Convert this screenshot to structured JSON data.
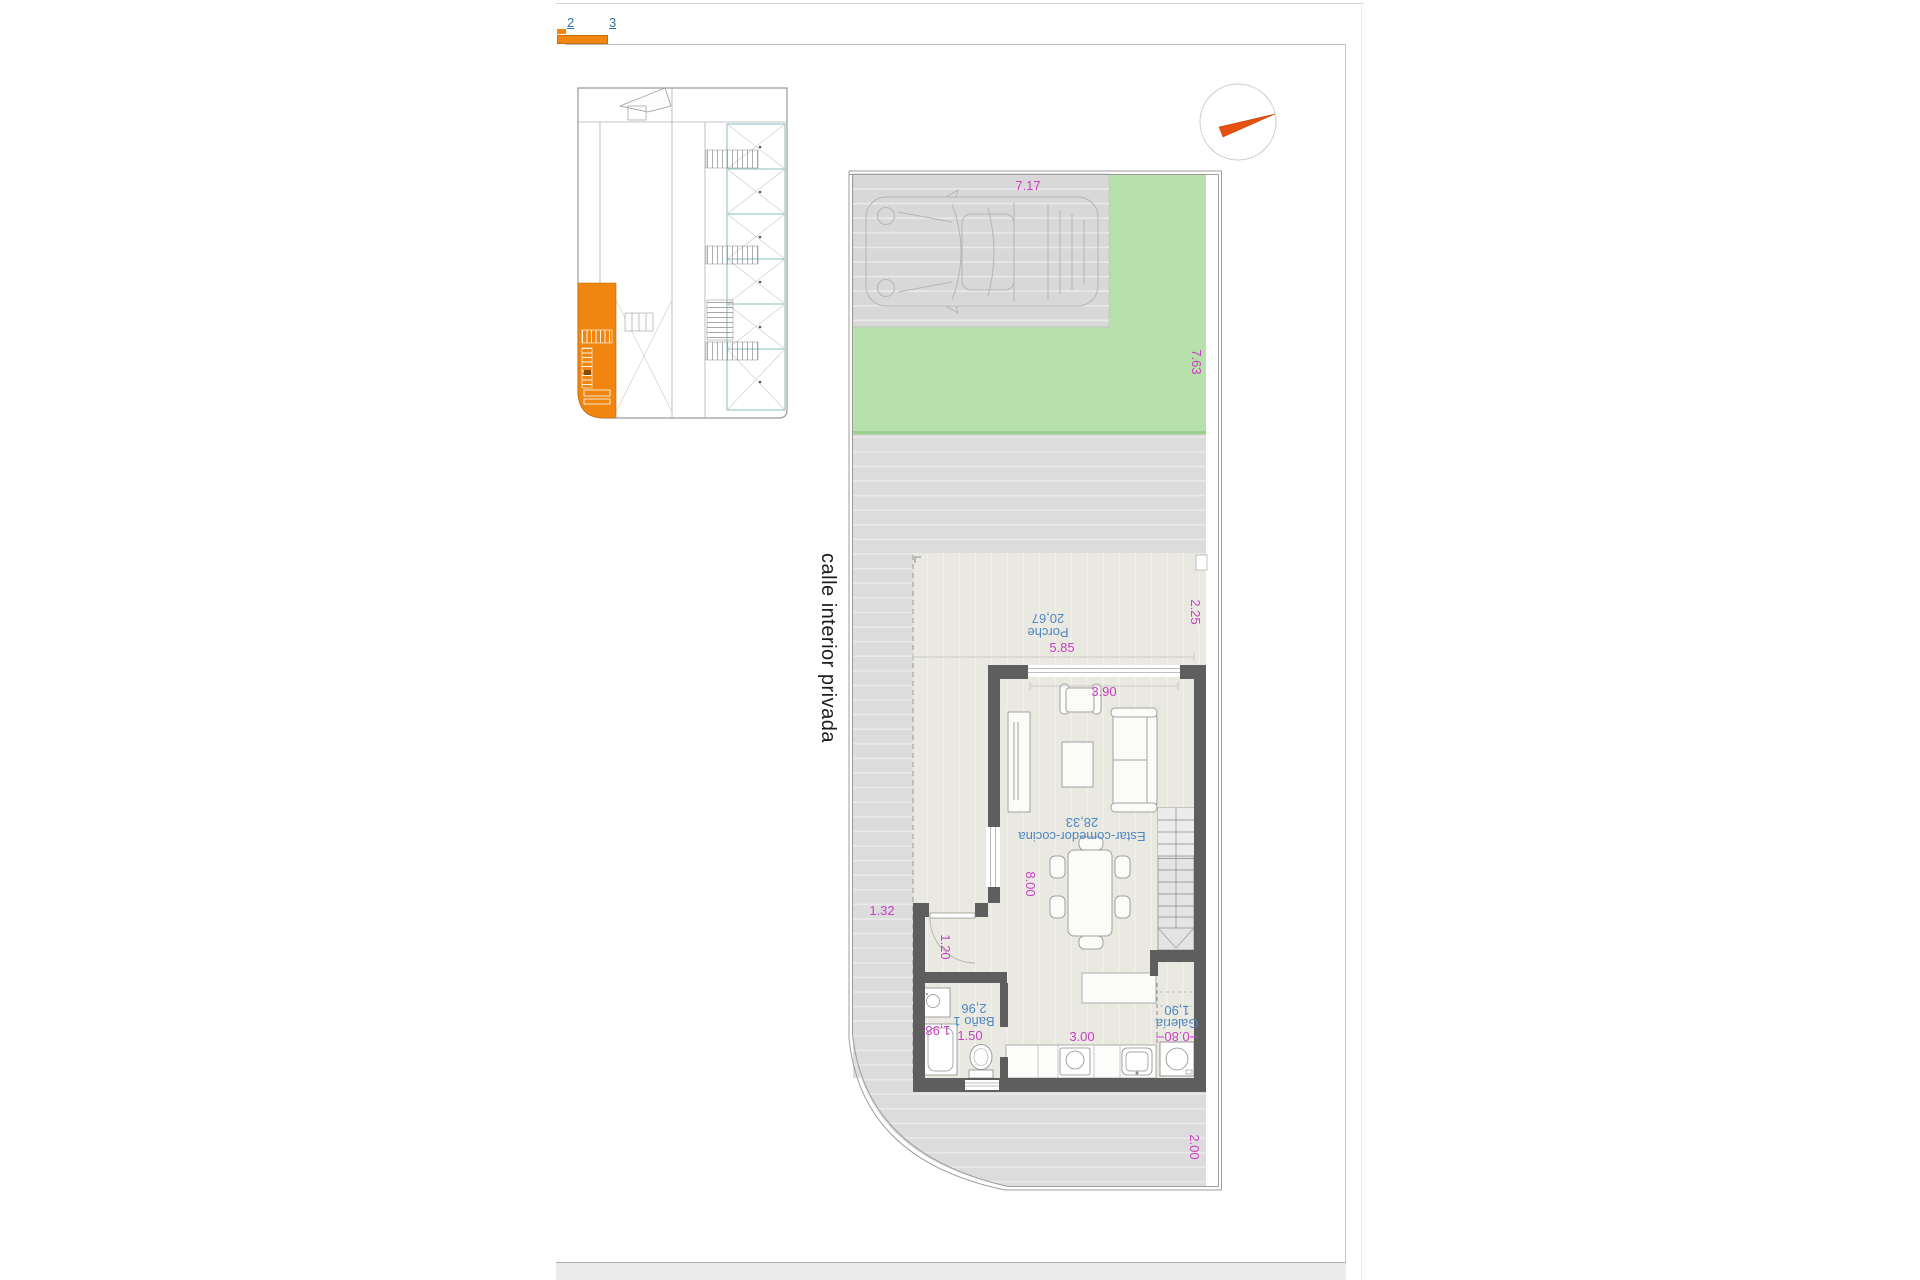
{
  "tabs": [
    {
      "label": "2"
    },
    {
      "label": "3"
    }
  ],
  "street_label": "calle interior privada",
  "rooms": {
    "porche": {
      "name": "Porche",
      "area": "20,67"
    },
    "estar": {
      "name": "Estar-comedor-cocina",
      "area": "28,33"
    },
    "bano": {
      "name": "Baño 1",
      "area": "2,96"
    },
    "galeria": {
      "name": "Galería",
      "area": "1,90"
    }
  },
  "dims": {
    "parking_width": "7.17",
    "garden_depth": "7.63",
    "porch_side": "2.25",
    "porch_width": "5.85",
    "window_width": "3.90",
    "living_depth": "8.00",
    "side_strip_width": "1.32",
    "entry_door": "1.20",
    "bath_width": "1.50",
    "bath_depth": "1,98",
    "kitchen_width": "3.00",
    "galeria_width": "0.80",
    "rear_margin": "2.00"
  },
  "colors": {
    "accent_orange": "#f0850f",
    "needle_orange": "#e8500f",
    "dim_magenta": "#c93fc4",
    "room_blue": "#4d86c2",
    "tab_blue": "#36719f",
    "lawn_green": "#b7e0ac",
    "lawn_edge": "#9bcf91",
    "wall_gray": "#5e5e5e",
    "paving_gray": "#dcdcdc",
    "floor_beige": "#eae9e1",
    "teal_line": "#8abec2"
  }
}
